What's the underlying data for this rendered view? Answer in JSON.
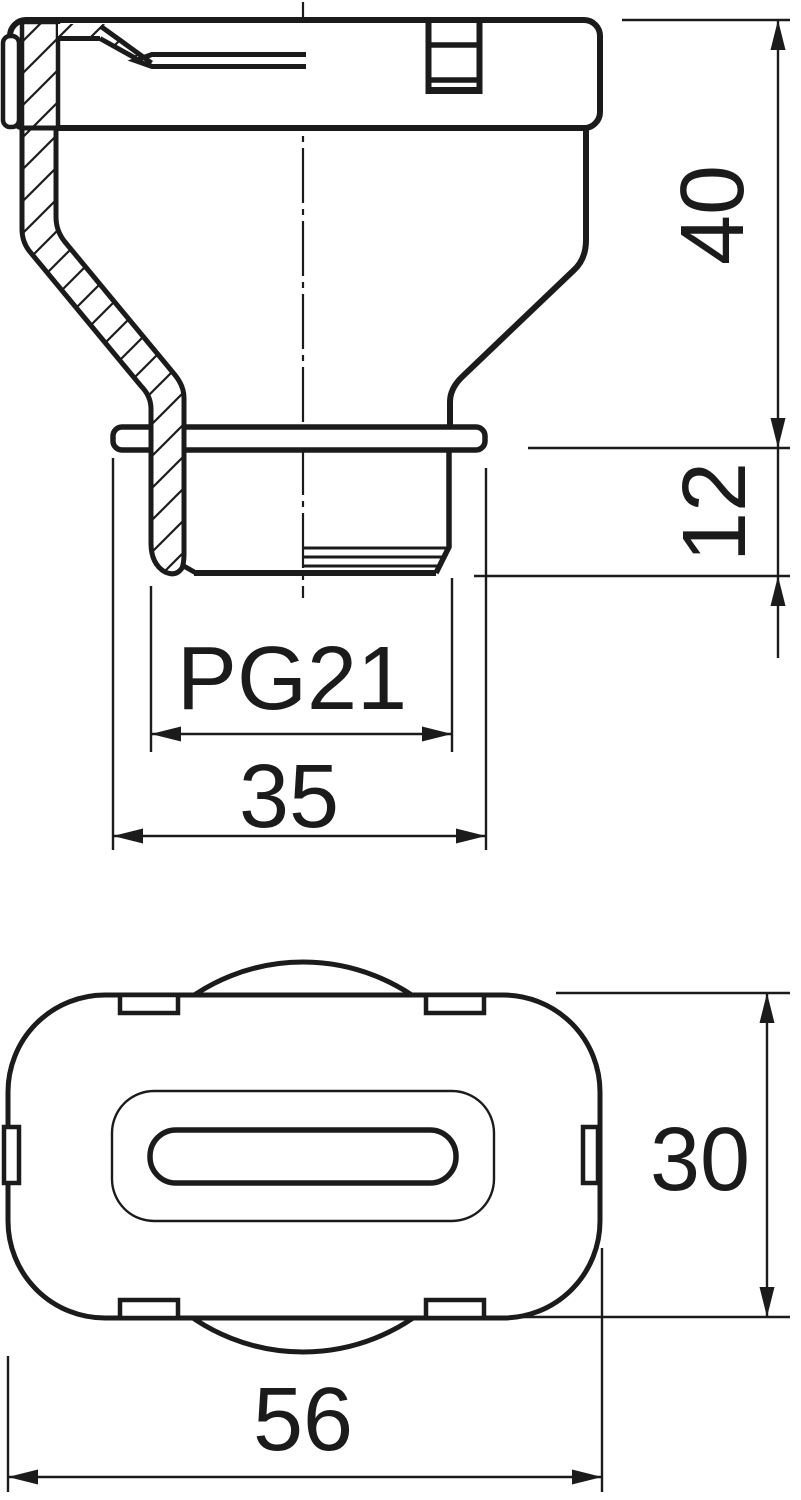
{
  "views": {
    "section": {
      "dimensions": {
        "height": {
          "label": "40"
        },
        "thread_length": {
          "label": "12"
        },
        "thread": {
          "label": "PG21"
        },
        "flange_width": {
          "label": "35"
        }
      }
    },
    "bottom": {
      "dimensions": {
        "height": {
          "label": "30"
        },
        "width": {
          "label": "56"
        }
      }
    }
  },
  "colors": {
    "line": "#1b1b1b",
    "background": "#ffffff"
  }
}
